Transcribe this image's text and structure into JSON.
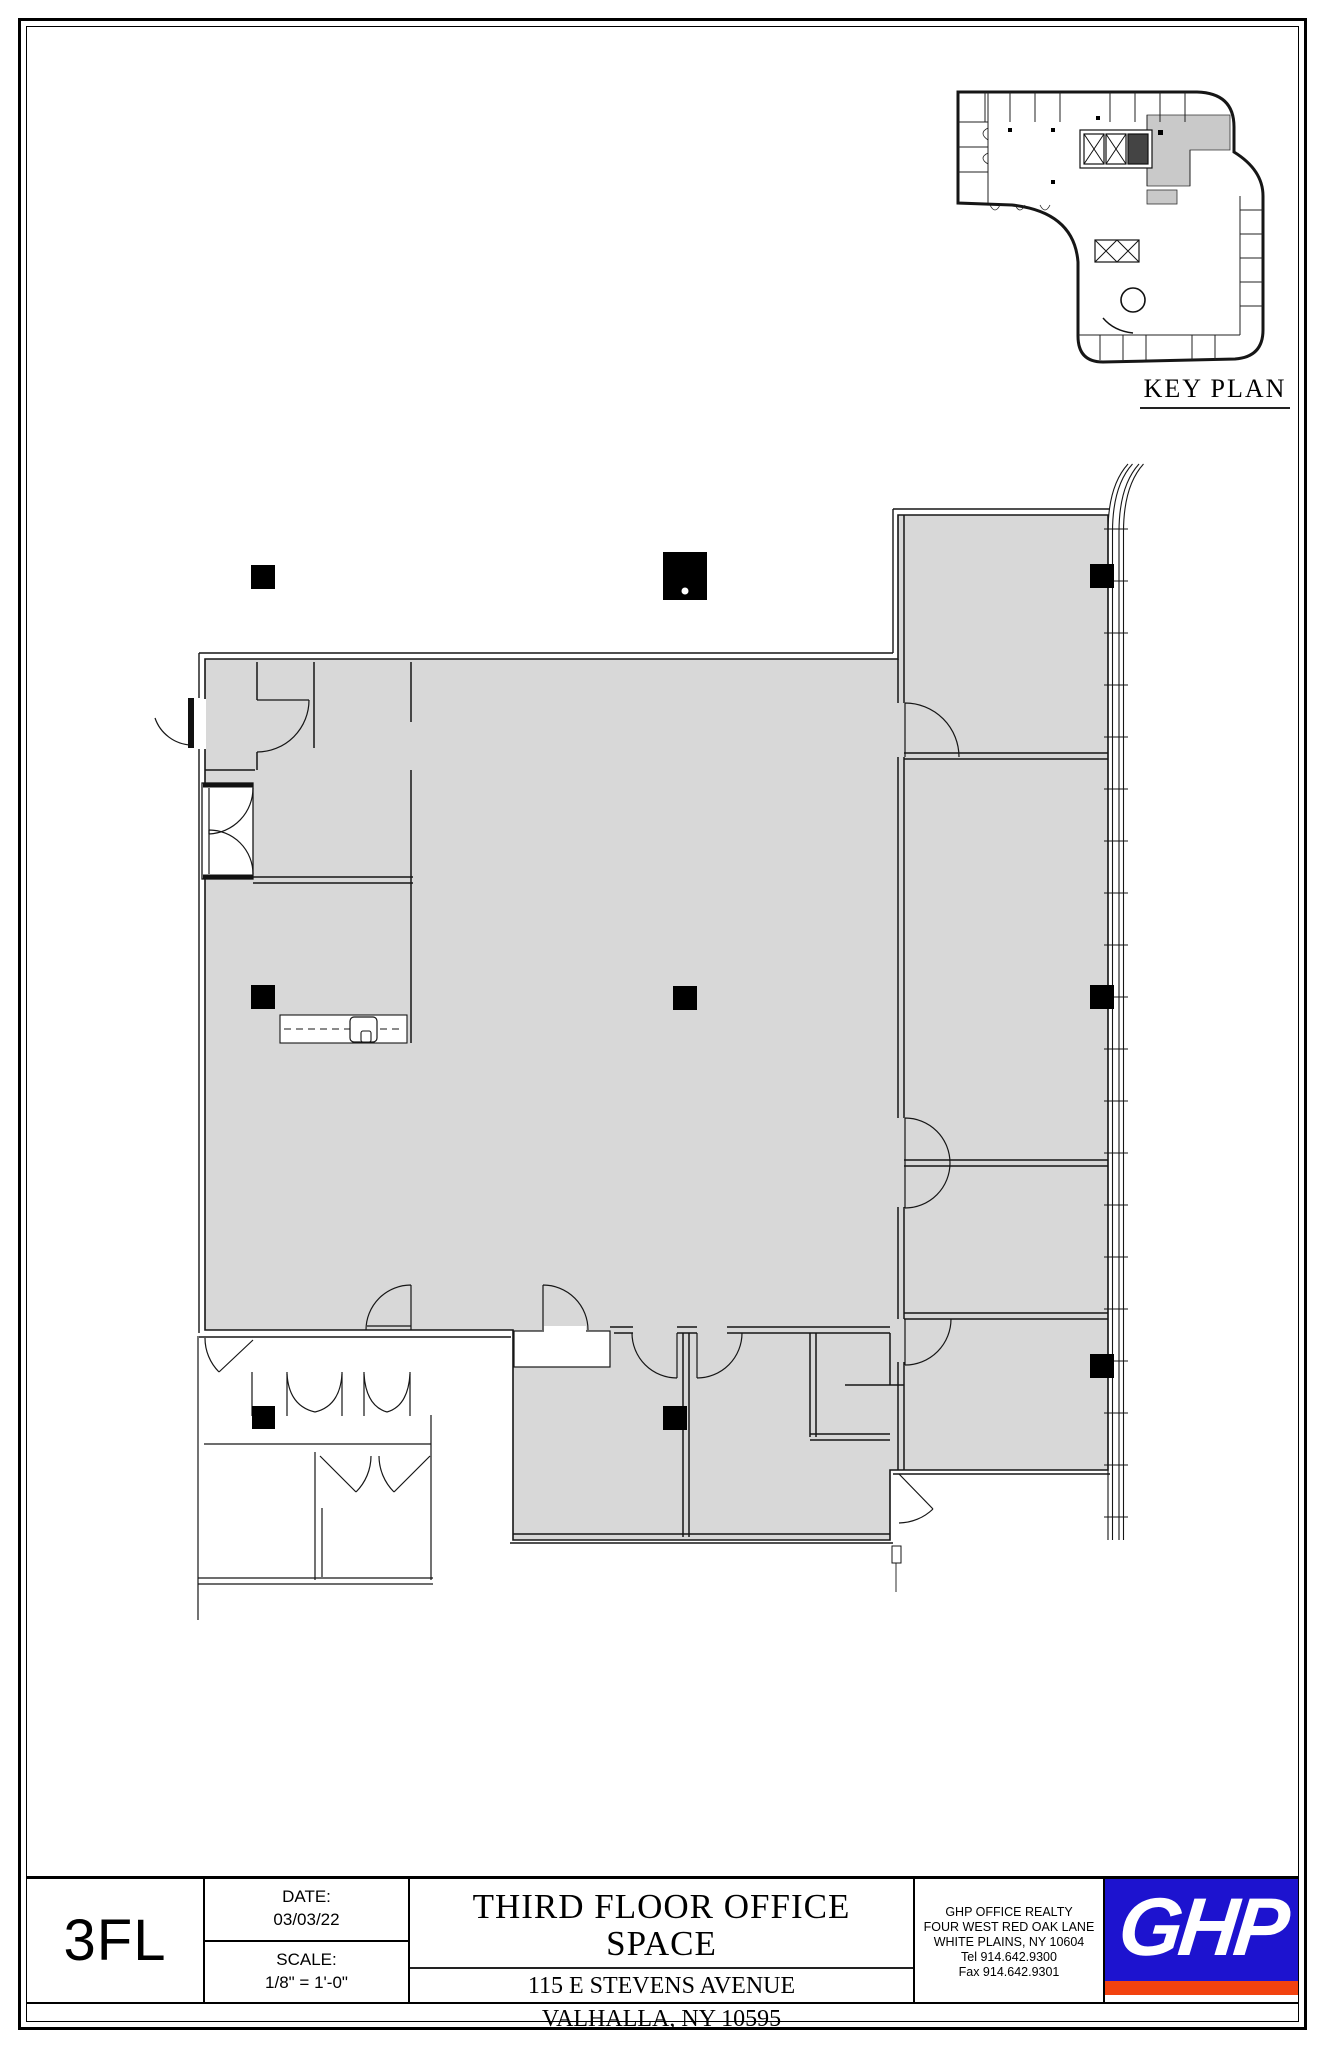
{
  "colors": {
    "wall": "#161616",
    "plan-fill": "#d8d8d8",
    "kp-fill": "#c9c9c9",
    "logo-blue": "#1d13cf",
    "logo-red": "#f2420f"
  },
  "key_plan": {
    "label": "KEY PLAN"
  },
  "title_block": {
    "floor_code": "3FL",
    "date_label": "DATE:",
    "date_value": "03/03/22",
    "scale_label": "SCALE:",
    "scale_value": "1/8\" = 1'-0\"",
    "project_title": "THIRD FLOOR OFFICE SPACE",
    "address_line1": "115 E STEVENS AVENUE",
    "address_line2": "VALHALLA, NY 10595",
    "firm": {
      "name": "GHP OFFICE REALTY",
      "address_line1": "FOUR WEST RED OAK LANE",
      "address_line2": "WHITE PLAINS, NY 10604",
      "tel": "Tel 914.642.9300",
      "fax": "Fax 914.642.9301"
    },
    "logo_text": "GHP"
  }
}
